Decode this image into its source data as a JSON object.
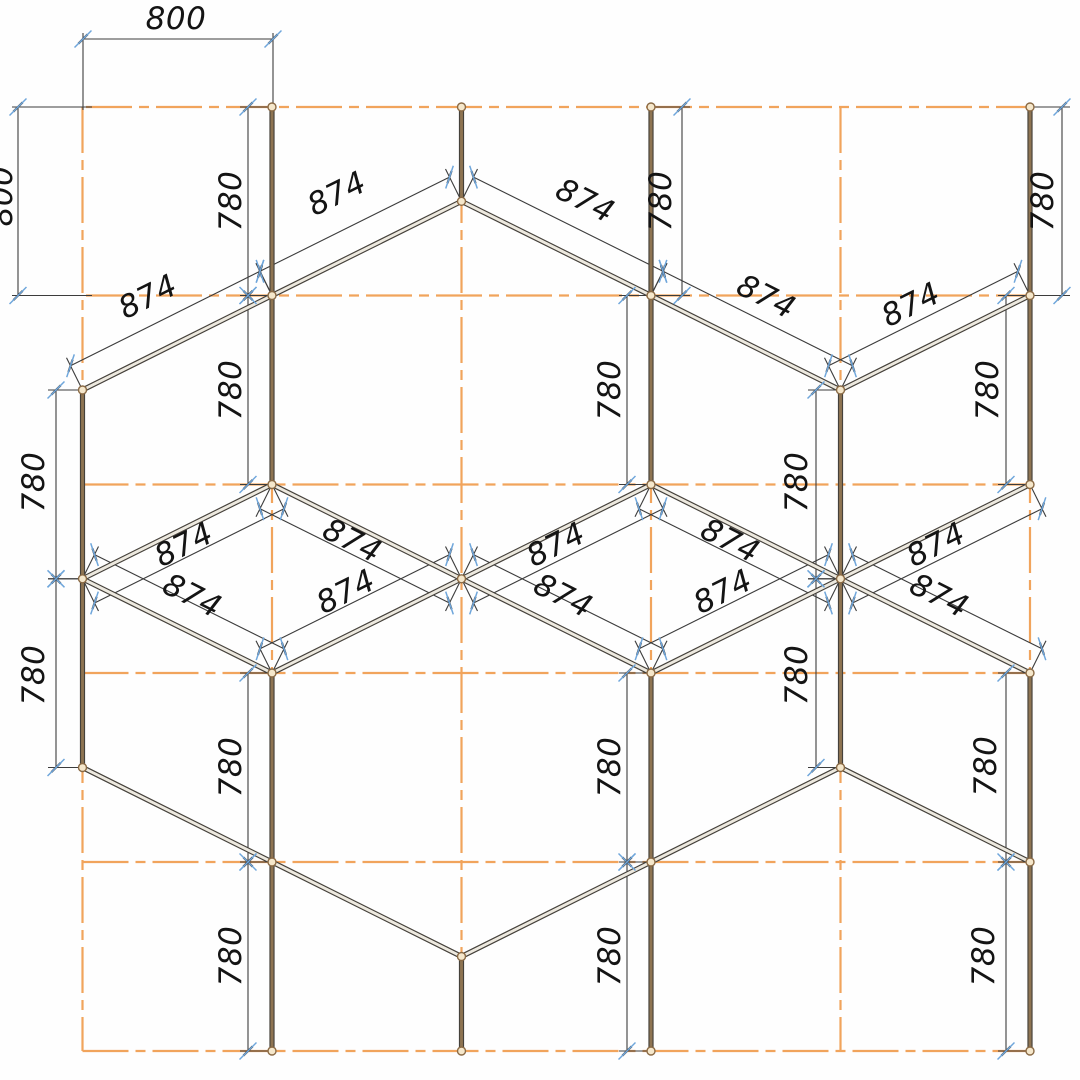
{
  "drawing": {
    "title": "structural-grid-elevation",
    "canvas": {
      "w": 1080,
      "h": 1080
    },
    "colors": {
      "background": "#fefefe",
      "grid": "#F1A45C",
      "member_edge": "#45413B",
      "member_core_vertical": "#8E7452",
      "member_core_diagonal": "#EDE9DF",
      "dim_line": "#3C3C3C",
      "tick_blue": "#6FA6DB",
      "tick_dark": "#3A3A3A",
      "node_fill": "#F5E7CB",
      "node_stroke": "#8A6A45",
      "text": "#141414"
    },
    "grid": {
      "cols": [
        82.5,
        272,
        461.5,
        651,
        840.5,
        1030
      ],
      "col_y1": 107,
      "col_y2": 1051,
      "rows": [
        {
          "y": 107,
          "x1": 86,
          "x2": 1030
        },
        {
          "y": 295.5,
          "x1": 86,
          "x2": 1030
        },
        {
          "y": 484.5,
          "x1": 82.5,
          "x2": 1030
        },
        {
          "y": 673,
          "x1": 82.5,
          "x2": 1030
        },
        {
          "y": 862,
          "x1": 82.5,
          "x2": 1030
        },
        {
          "y": 1051,
          "x1": 82.5,
          "x2": 1034
        }
      ],
      "dash": "46 7 10 7"
    },
    "members": {
      "verticals": [
        [
          272,
          107,
          272,
          484.5
        ],
        [
          461.5,
          107,
          461.5,
          201.3
        ],
        [
          651,
          107,
          651,
          484.5
        ],
        [
          1030,
          107,
          1030,
          484.5
        ],
        [
          82.5,
          390,
          82.5,
          767.5
        ],
        [
          840.5,
          390,
          840.5,
          767.5
        ],
        [
          272,
          673,
          272,
          1051
        ],
        [
          651,
          673,
          651,
          1051
        ],
        [
          1030,
          673,
          1030,
          1051
        ],
        [
          461.5,
          956.5,
          461.5,
          1051
        ]
      ],
      "diagonals": [
        [
          461.5,
          201.3,
          272,
          295.5
        ],
        [
          461.5,
          201.3,
          651,
          295.5
        ],
        [
          272,
          295.5,
          82.5,
          390
        ],
        [
          651,
          295.5,
          840.5,
          390
        ],
        [
          1030,
          295.5,
          840.5,
          390
        ],
        [
          272,
          484.5,
          82.5,
          578.8
        ],
        [
          272,
          484.5,
          461.5,
          578.8
        ],
        [
          82.5,
          578.8,
          272,
          673
        ],
        [
          461.5,
          578.8,
          272,
          673
        ],
        [
          651,
          484.5,
          461.5,
          578.8
        ],
        [
          651,
          484.5,
          840.5,
          578.8
        ],
        [
          461.5,
          578.8,
          651,
          673
        ],
        [
          840.5,
          578.8,
          651,
          673
        ],
        [
          1030,
          484.5,
          840.5,
          578.8
        ],
        [
          840.5,
          578.8,
          1030,
          673
        ],
        [
          82.5,
          767.5,
          272,
          862
        ],
        [
          272,
          862,
          461.5,
          956.5
        ],
        [
          840.5,
          767.5,
          651,
          862
        ],
        [
          651,
          862,
          461.5,
          956.5
        ],
        [
          840.5,
          767.5,
          1030,
          862
        ]
      ]
    },
    "nodes": [
      [
        272,
        107
      ],
      [
        461.5,
        107
      ],
      [
        651,
        107
      ],
      [
        1030,
        107
      ],
      [
        461.5,
        201.3
      ],
      [
        272,
        295.5
      ],
      [
        651,
        295.5
      ],
      [
        1030,
        295.5
      ],
      [
        82.5,
        390
      ],
      [
        840.5,
        390
      ],
      [
        272,
        484.5
      ],
      [
        651,
        484.5
      ],
      [
        1030,
        484.5
      ],
      [
        82.5,
        578.8
      ],
      [
        461.5,
        578.8
      ],
      [
        840.5,
        578.8
      ],
      [
        272,
        673
      ],
      [
        651,
        673
      ],
      [
        1030,
        673
      ],
      [
        82.5,
        767.5
      ],
      [
        840.5,
        767.5
      ],
      [
        272,
        862
      ],
      [
        651,
        862
      ],
      [
        1030,
        862
      ],
      [
        461.5,
        956.5
      ],
      [
        272,
        1051
      ],
      [
        461.5,
        1051
      ],
      [
        651,
        1051
      ],
      [
        1030,
        1051
      ]
    ],
    "dims": {
      "vertical": [
        {
          "x": 248,
          "y1": 107,
          "y2": 295.5,
          "sx": 272,
          "value": "780"
        },
        {
          "x": 248,
          "y1": 295.5,
          "y2": 484.5,
          "sx": 272,
          "value": "780"
        },
        {
          "x": 682,
          "y1": 107,
          "y2": 295.5,
          "sx": 651,
          "value": "780"
        },
        {
          "x": 627,
          "y1": 295.5,
          "y2": 484.5,
          "sx": 651,
          "value": "780"
        },
        {
          "x": 1062,
          "y1": 107,
          "y2": 295.5,
          "sx": 1030,
          "value": "780"
        },
        {
          "x": 1006,
          "y1": 295.5,
          "y2": 484.5,
          "sx": 1030,
          "value": "780"
        },
        {
          "x": 56,
          "y1": 390,
          "y2": 578.8,
          "sx": 82.5,
          "value": "780"
        },
        {
          "x": 56,
          "y1": 578.8,
          "y2": 767.5,
          "sx": 82.5,
          "value": "780"
        },
        {
          "x": 816,
          "y1": 390,
          "y2": 578.8,
          "sx": 840.5,
          "value": "780"
        },
        {
          "x": 816,
          "y1": 578.8,
          "y2": 767.5,
          "sx": 840.5,
          "value": "780"
        },
        {
          "x": 248,
          "y1": 673,
          "y2": 862,
          "sx": 272,
          "value": "780"
        },
        {
          "x": 248,
          "y1": 862,
          "y2": 1051,
          "sx": 272,
          "value": "780"
        },
        {
          "x": 627,
          "y1": 673,
          "y2": 862,
          "sx": 651,
          "value": "780"
        },
        {
          "x": 627,
          "y1": 862,
          "y2": 1051,
          "sx": 651,
          "value": "780"
        },
        {
          "x": 1006,
          "y1": 673,
          "y2": 862,
          "sx": 1030,
          "value": "780"
        },
        {
          "x": 1006,
          "y1": 862,
          "y2": 1051,
          "sx": 1030,
          "value": "780"
        }
      ],
      "horizontal": [
        {
          "y": 39,
          "x1": 83,
          "x2": 273,
          "stub_y2": 110,
          "value": "800"
        }
      ],
      "left_edge": [
        {
          "x": 18,
          "y1": 107,
          "y2": 295.5,
          "stub_x2": 92,
          "value": "800"
        }
      ],
      "diagonal": [
        {
          "x1": 461.5,
          "y1": 201.3,
          "x2": 272,
          "y2": 295.5,
          "nx": -12,
          "ny": -24.2,
          "value": "874"
        },
        {
          "x1": 461.5,
          "y1": 201.3,
          "x2": 651,
          "y2": 295.5,
          "nx": 12,
          "ny": -24.2,
          "value": "874"
        },
        {
          "x1": 272,
          "y1": 295.5,
          "x2": 82.5,
          "y2": 390,
          "nx": -12,
          "ny": -24.2,
          "value": "874"
        },
        {
          "x1": 651,
          "y1": 295.5,
          "x2": 840.5,
          "y2": 390,
          "nx": 12,
          "ny": -24.2,
          "value": "874"
        },
        {
          "x1": 1030,
          "y1": 295.5,
          "x2": 840.5,
          "y2": 390,
          "nx": -12,
          "ny": -24.2,
          "value": "874"
        },
        {
          "x1": 82.5,
          "y1": 578.8,
          "x2": 272,
          "y2": 484.5,
          "nx": 12,
          "ny": 24.2,
          "value": "874"
        },
        {
          "x1": 272,
          "y1": 484.5,
          "x2": 461.5,
          "y2": 578.8,
          "nx": -12,
          "ny": 24.2,
          "value": "874"
        },
        {
          "x1": 82.5,
          "y1": 578.8,
          "x2": 272,
          "y2": 673,
          "nx": 12,
          "ny": -24.2,
          "value": "874"
        },
        {
          "x1": 272,
          "y1": 673,
          "x2": 461.5,
          "y2": 578.8,
          "nx": -12,
          "ny": -24.2,
          "value": "874"
        },
        {
          "x1": 461.5,
          "y1": 578.8,
          "x2": 651,
          "y2": 484.5,
          "nx": 12,
          "ny": 24.2,
          "value": "874"
        },
        {
          "x1": 651,
          "y1": 484.5,
          "x2": 840.5,
          "y2": 578.8,
          "nx": -12,
          "ny": 24.2,
          "value": "874"
        },
        {
          "x1": 461.5,
          "y1": 578.8,
          "x2": 651,
          "y2": 673,
          "nx": 12,
          "ny": -24.2,
          "value": "874"
        },
        {
          "x1": 651,
          "y1": 673,
          "x2": 840.5,
          "y2": 578.8,
          "nx": -12,
          "ny": -24.2,
          "value": "874"
        },
        {
          "x1": 840.5,
          "y1": 578.8,
          "x2": 1030,
          "y2": 484.5,
          "nx": 12,
          "ny": 24.2,
          "value": "874"
        },
        {
          "x1": 840.5,
          "y1": 578.8,
          "x2": 1030,
          "y2": 673,
          "nx": 12,
          "ny": -24.2,
          "value": "874"
        }
      ]
    },
    "labels": [
      {
        "t": "800",
        "x": 176,
        "y": 19,
        "r": 0
      },
      {
        "t": "800",
        "x": 2,
        "y": 196,
        "r": -90
      },
      {
        "t": "780",
        "x": 231,
        "y": 201,
        "r": -90
      },
      {
        "t": "780",
        "x": 231,
        "y": 390,
        "r": -90
      },
      {
        "t": "780",
        "x": 661,
        "y": 201,
        "r": -90
      },
      {
        "t": "780",
        "x": 610,
        "y": 390,
        "r": -90
      },
      {
        "t": "780",
        "x": 1043,
        "y": 201,
        "r": -90
      },
      {
        "t": "780",
        "x": 988,
        "y": 390,
        "r": -90
      },
      {
        "t": "780",
        "x": 34,
        "y": 482,
        "r": -90
      },
      {
        "t": "780",
        "x": 34,
        "y": 675,
        "r": -90
      },
      {
        "t": "780",
        "x": 797,
        "y": 482,
        "r": -90
      },
      {
        "t": "780",
        "x": 797,
        "y": 675,
        "r": -90
      },
      {
        "t": "780",
        "x": 231,
        "y": 767,
        "r": -90
      },
      {
        "t": "780",
        "x": 231,
        "y": 956,
        "r": -90
      },
      {
        "t": "780",
        "x": 610,
        "y": 767,
        "r": -90
      },
      {
        "t": "780",
        "x": 610,
        "y": 956,
        "r": -90
      },
      {
        "t": "780",
        "x": 986,
        "y": 766,
        "r": -90
      },
      {
        "t": "780",
        "x": 984,
        "y": 956,
        "r": -90
      },
      {
        "t": "874",
        "x": 337,
        "y": 194,
        "r": -26.57
      },
      {
        "t": "874",
        "x": 585,
        "y": 201,
        "r": 26.57
      },
      {
        "t": "874",
        "x": 148,
        "y": 297,
        "r": -26.57
      },
      {
        "t": "874",
        "x": 766,
        "y": 297,
        "r": 26.57
      },
      {
        "t": "874",
        "x": 911,
        "y": 305,
        "r": -26.57
      },
      {
        "t": "874",
        "x": 184,
        "y": 545,
        "r": -26.57
      },
      {
        "t": "874",
        "x": 352,
        "y": 541,
        "r": 26.57
      },
      {
        "t": "874",
        "x": 556,
        "y": 545,
        "r": -26.57
      },
      {
        "t": "874",
        "x": 730,
        "y": 541,
        "r": 26.57
      },
      {
        "t": "874",
        "x": 936,
        "y": 545,
        "r": -26.57
      },
      {
        "t": "874",
        "x": 192,
        "y": 596,
        "r": 26.57
      },
      {
        "t": "874",
        "x": 346,
        "y": 592,
        "r": -26.57
      },
      {
        "t": "874",
        "x": 563,
        "y": 596,
        "r": 26.57
      },
      {
        "t": "874",
        "x": 723,
        "y": 592,
        "r": -26.57
      },
      {
        "t": "874",
        "x": 939,
        "y": 596,
        "r": 26.57
      }
    ],
    "style": {
      "font_size": 31,
      "member_width": 5.2,
      "core_width": 2.9,
      "node_radius": 4,
      "dim_width": 1.1,
      "blue_tick_halflen": 12,
      "dark_tick_halflen": 6.5
    }
  }
}
